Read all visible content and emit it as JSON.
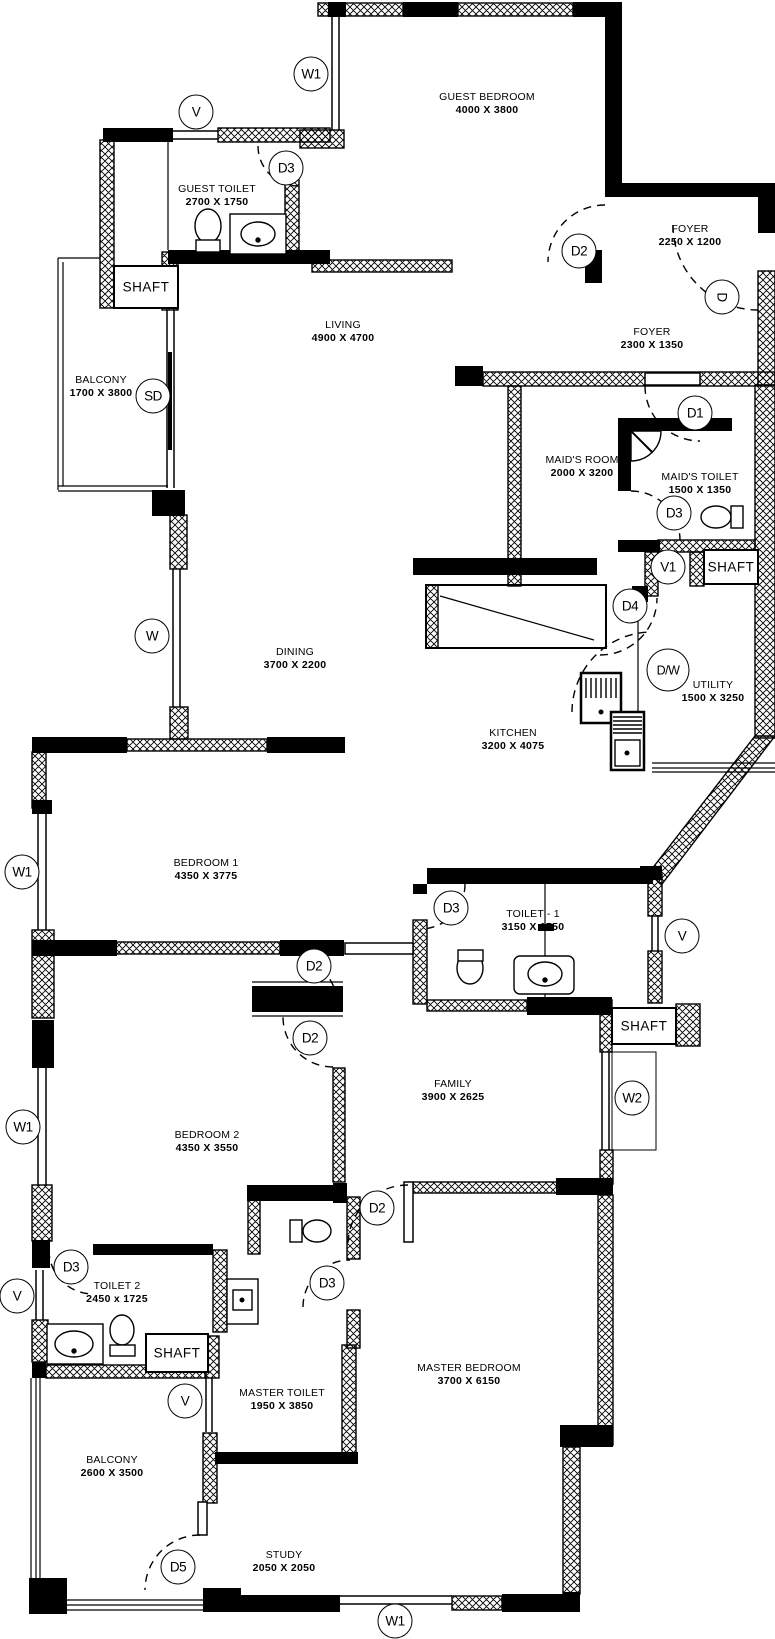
{
  "drawing": {
    "type": "apartment-floor-plan",
    "ink_color": "#000000",
    "paper_color": "#ffffff"
  },
  "rooms": [
    {
      "name": "GUEST BEDROOM",
      "dims": "4000 X 3800"
    },
    {
      "name": "GUEST TOILET",
      "dims": "2700 X 1750"
    },
    {
      "name": "FOYER",
      "dims": "2250 X 1200"
    },
    {
      "name": "FOYER",
      "dims": "2300 X 1350"
    },
    {
      "name": "LIVING",
      "dims": "4900 X 4700"
    },
    {
      "name": "BALCONY",
      "dims": "1700 X 3800"
    },
    {
      "name": "MAID'S ROOM",
      "dims": "2000 X 3200"
    },
    {
      "name": "MAID'S TOILET",
      "dims": "1500 X 1350"
    },
    {
      "name": "UTILITY",
      "dims": "1500 X 3250"
    },
    {
      "name": "DINING",
      "dims": "3700 X 2200"
    },
    {
      "name": "KITCHEN",
      "dims": "3200 X 4075"
    },
    {
      "name": "BEDROOM 1",
      "dims": "4350 X 3775"
    },
    {
      "name": "TOILET - 1",
      "dims": "3150 X 1750"
    },
    {
      "name": "FAMILY",
      "dims": "3900 X 2625"
    },
    {
      "name": "BEDROOM 2",
      "dims": "4350 X 3550"
    },
    {
      "name": "TOILET 2",
      "dims": "2450 x 1725"
    },
    {
      "name": "MASTER TOILET",
      "dims": "1950 X 3850"
    },
    {
      "name": "MASTER BEDROOM",
      "dims": "3700 X 6150"
    },
    {
      "name": "BALCONY",
      "dims": "2600 X 3500"
    },
    {
      "name": "STUDY",
      "dims": "2050 X 2050"
    }
  ],
  "shafts": [
    {
      "label": "SHAFT"
    },
    {
      "label": "SHAFT"
    },
    {
      "label": "SHAFT"
    },
    {
      "label": "SHAFT"
    }
  ],
  "symbols": [
    {
      "label": "W1"
    },
    {
      "label": "V"
    },
    {
      "label": "D3"
    },
    {
      "label": "D2"
    },
    {
      "label": "D"
    },
    {
      "label": "SD"
    },
    {
      "label": "D1"
    },
    {
      "label": "D3"
    },
    {
      "label": "V1"
    },
    {
      "label": "D4"
    },
    {
      "label": "D/W"
    },
    {
      "label": "W"
    },
    {
      "label": "W1"
    },
    {
      "label": "D3"
    },
    {
      "label": "V"
    },
    {
      "label": "D2"
    },
    {
      "label": "D2"
    },
    {
      "label": "W2"
    },
    {
      "label": "W1"
    },
    {
      "label": "D2"
    },
    {
      "label": "D3"
    },
    {
      "label": "D3"
    },
    {
      "label": "V"
    },
    {
      "label": "V"
    },
    {
      "label": "D5"
    },
    {
      "label": "W1"
    }
  ]
}
